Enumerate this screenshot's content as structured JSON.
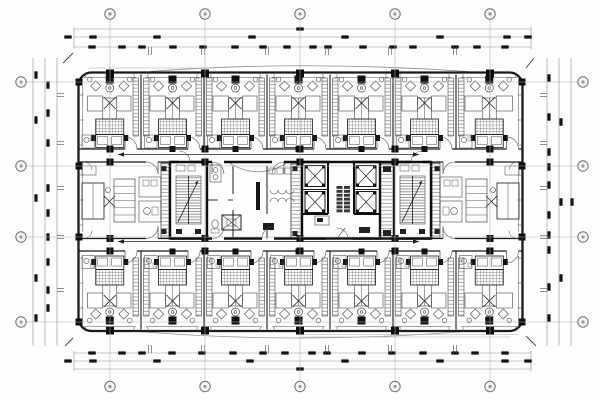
{
  "drawing_type": "architectural-floor-plan",
  "palette": {
    "paper": "#fdfdfd",
    "ink": "#1a1a1a",
    "bold": "#0d0d0d",
    "mid": "#4a4a4a",
    "light": "#8f8f8f",
    "faint": "#b3b3b3",
    "fill_dark": "#101010",
    "blob": "#141414"
  },
  "canvas": {
    "width": 600,
    "height": 400
  },
  "building": {
    "x": 78.5,
    "y": 72.5,
    "w": 444,
    "h": 258.5,
    "corner_radius": 13
  },
  "grid": {
    "cols_x": [
      110,
      205,
      300,
      395,
      490
    ],
    "rows_y": [
      82,
      166,
      237,
      322
    ],
    "bubble_r": 5.2,
    "top_bubble_y": 14,
    "bottom_bubble_y": 386.5,
    "left_bubble_x": 21,
    "right_bubble_x": 583,
    "v_extent": [
      19.5,
      381
    ],
    "h_extent": [
      27,
      577
    ]
  },
  "bands": {
    "room_top": [
      74.5,
      149
    ],
    "corridor_top": [
      149,
      162
    ],
    "core": [
      162,
      238.5
    ],
    "corridor_bottom": [
      238.5,
      251
    ],
    "room_bottom": [
      251,
      329.5
    ]
  },
  "rooms": {
    "edges_x": [
      78.5,
      141,
      204,
      267,
      330,
      393,
      456,
      522.5
    ]
  },
  "core": {
    "stair_west": [
      170,
      162,
      37,
      76.5
    ],
    "stair_east": [
      394,
      162,
      37,
      76.5
    ],
    "service": [
      207,
      291
    ],
    "duct_a": [
      291,
      302
    ],
    "elevator_block": [
      302,
      380
    ],
    "duct_b": [
      380,
      394
    ],
    "suite_west": [
      78.5,
      170
    ],
    "suite_east": [
      431,
      522.5
    ]
  },
  "dimensions": {
    "top": {
      "lines_y": [
        29,
        37,
        47
      ],
      "run": [
        74,
        531
      ],
      "blobs": [
        {
          "y": 29,
          "xs": [
            300
          ]
        },
        {
          "y": 37,
          "xs": [
            68,
            93,
            157,
            252,
            345,
            440,
            507,
            528
          ]
        },
        {
          "y": 47,
          "xs": [
            92,
            122,
            142,
            173,
            203,
            235,
            263,
            287,
            313,
            328,
            363,
            393,
            413,
            455,
            477,
            505
          ]
        }
      ],
      "ticks_x": [
        150,
        203,
        267,
        327,
        390,
        455
      ]
    },
    "bottom": {
      "lines_y": [
        353,
        361,
        369
      ],
      "run": [
        74,
        531
      ],
      "blobs": [
        {
          "y": 369,
          "xs": [
            300
          ]
        },
        {
          "y": 361,
          "xs": [
            68,
            93,
            157,
            250,
            345,
            440,
            505,
            528
          ]
        },
        {
          "y": 353,
          "xs": [
            92,
            122,
            142,
            172,
            202,
            233,
            263,
            285,
            312,
            327,
            362,
            392,
            423,
            455,
            475,
            505
          ]
        }
      ],
      "ticks_x": [
        150,
        203,
        267,
        327,
        390,
        455
      ]
    },
    "left": {
      "lines_x": [
        33,
        45,
        57
      ],
      "run": [
        58,
        346
      ],
      "blobs": [
        {
          "x": 36,
          "ys": [
            75,
            120,
            198,
            278,
            318
          ]
        },
        {
          "x": 48,
          "ys": [
            85,
            113,
            143,
            188,
            213,
            237,
            262,
            290,
            308
          ]
        }
      ],
      "ticks_y": [
        95,
        143,
        188,
        237,
        290
      ]
    },
    "right": {
      "lines_x": [
        547,
        559,
        571
      ],
      "run": [
        58,
        346
      ],
      "blobs": [
        {
          "x": 549,
          "ys": [
            78,
            117,
            152,
            167,
            185,
            215,
            235,
            250,
            287,
            318
          ]
        },
        {
          "x": 561,
          "ys": [
            122,
            202,
            278
          ]
        },
        {
          "x": 572,
          "ys": [
            202
          ]
        }
      ],
      "ticks_y": [
        95,
        143,
        188,
        237,
        290
      ]
    }
  },
  "annotations": {
    "corridor_arrows": [
      {
        "y": 154.5,
        "x0": 118,
        "x1": 419
      },
      {
        "y": 241.5,
        "x0": 118,
        "x1": 419
      }
    ],
    "canopy_top": {
      "x0": 150,
      "apex_y": 60,
      "x1": 468,
      "wall_y": 71.5
    },
    "canopy_bottom": {
      "x0": 132,
      "apex_y": 345,
      "x1": 470,
      "wall_y": 331
    },
    "corner_ticks": [
      [
        63,
        63,
        73,
        53
      ],
      [
        526,
        68,
        534,
        58
      ],
      [
        526,
        336,
        536,
        346
      ],
      [
        65,
        346,
        73,
        338
      ]
    ]
  }
}
